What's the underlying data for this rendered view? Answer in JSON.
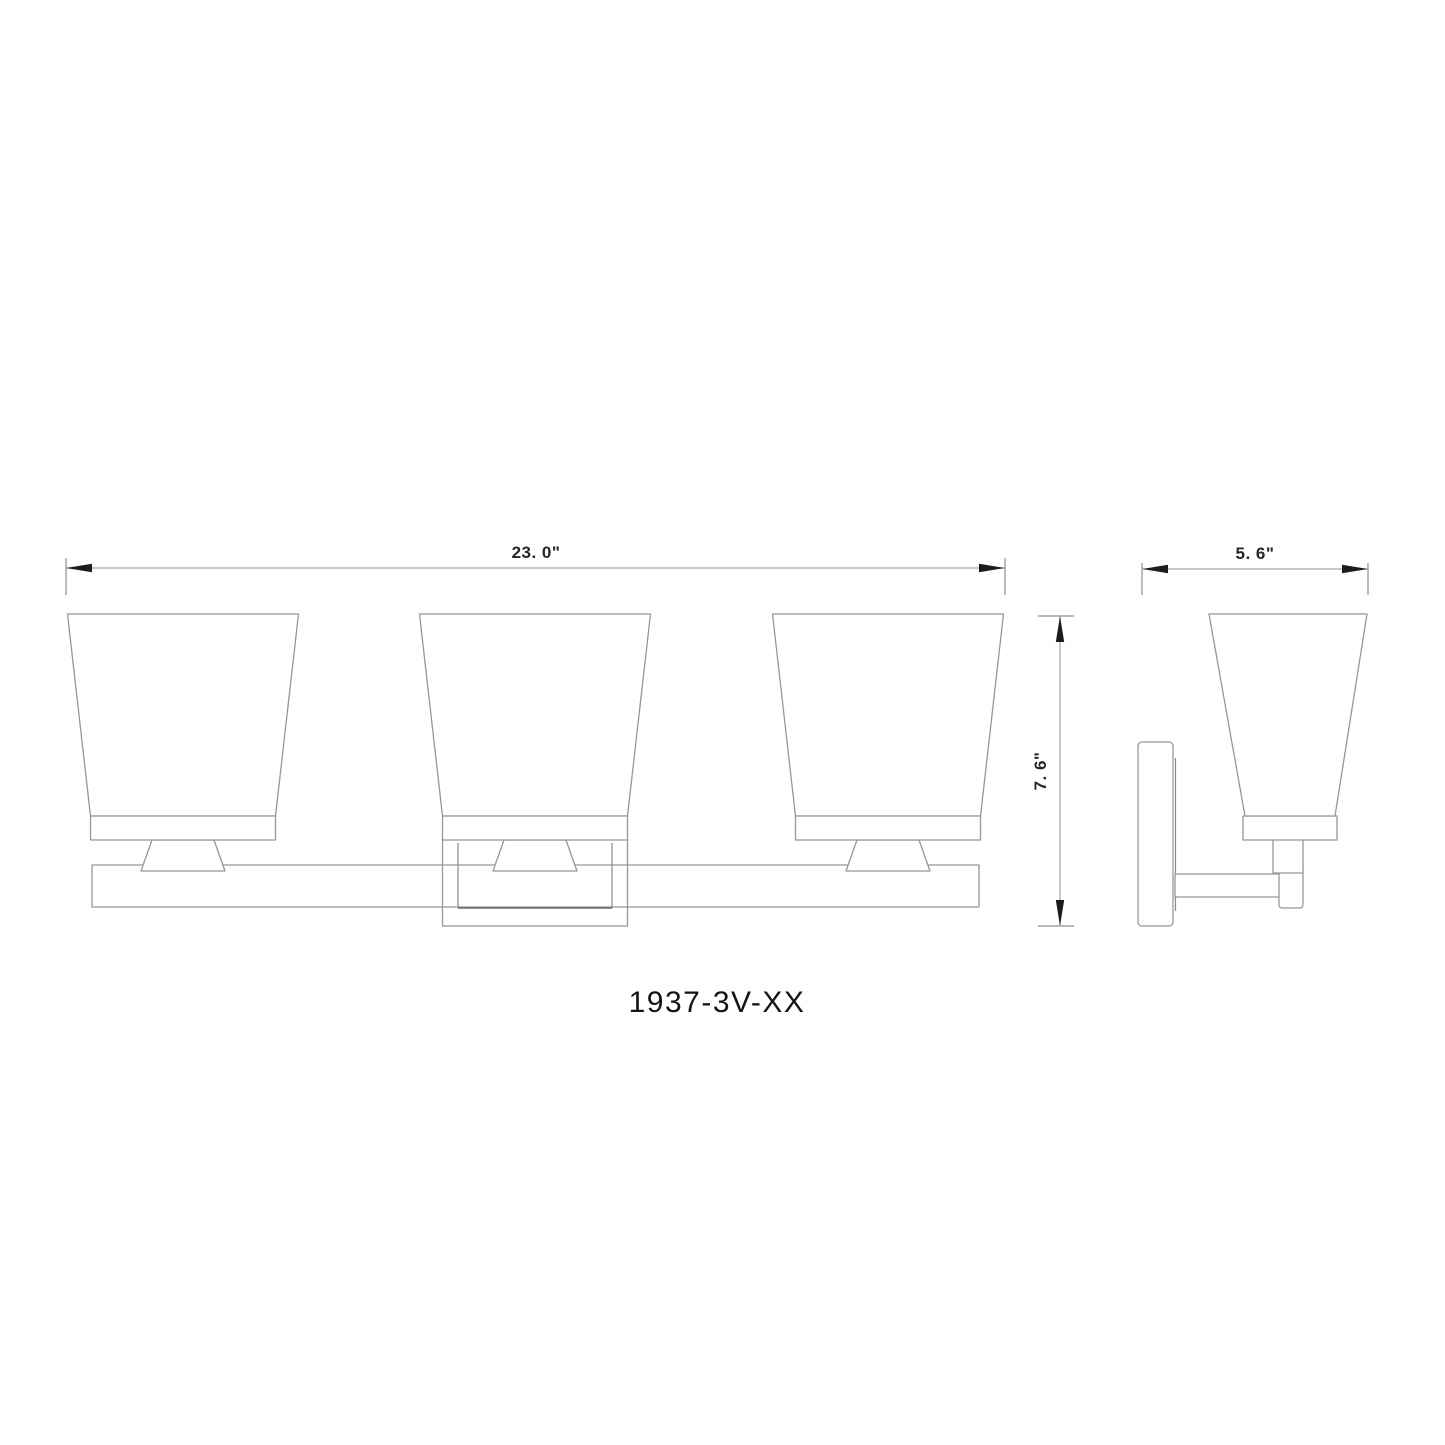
{
  "drawing": {
    "model_label": "1937-3V-XX",
    "light_count": 3,
    "dimensions": {
      "front_width": {
        "label": "23. 0\""
      },
      "side_depth": {
        "label": "5. 6\""
      },
      "front_height": {
        "label": "7. 6\""
      }
    },
    "colors": {
      "background": "#ffffff",
      "outline": "#979797",
      "dimension_line": "#a6a6a6",
      "arrow": "#1c1c1c",
      "dimension_text": "#262626",
      "model_text": "#141414"
    }
  }
}
